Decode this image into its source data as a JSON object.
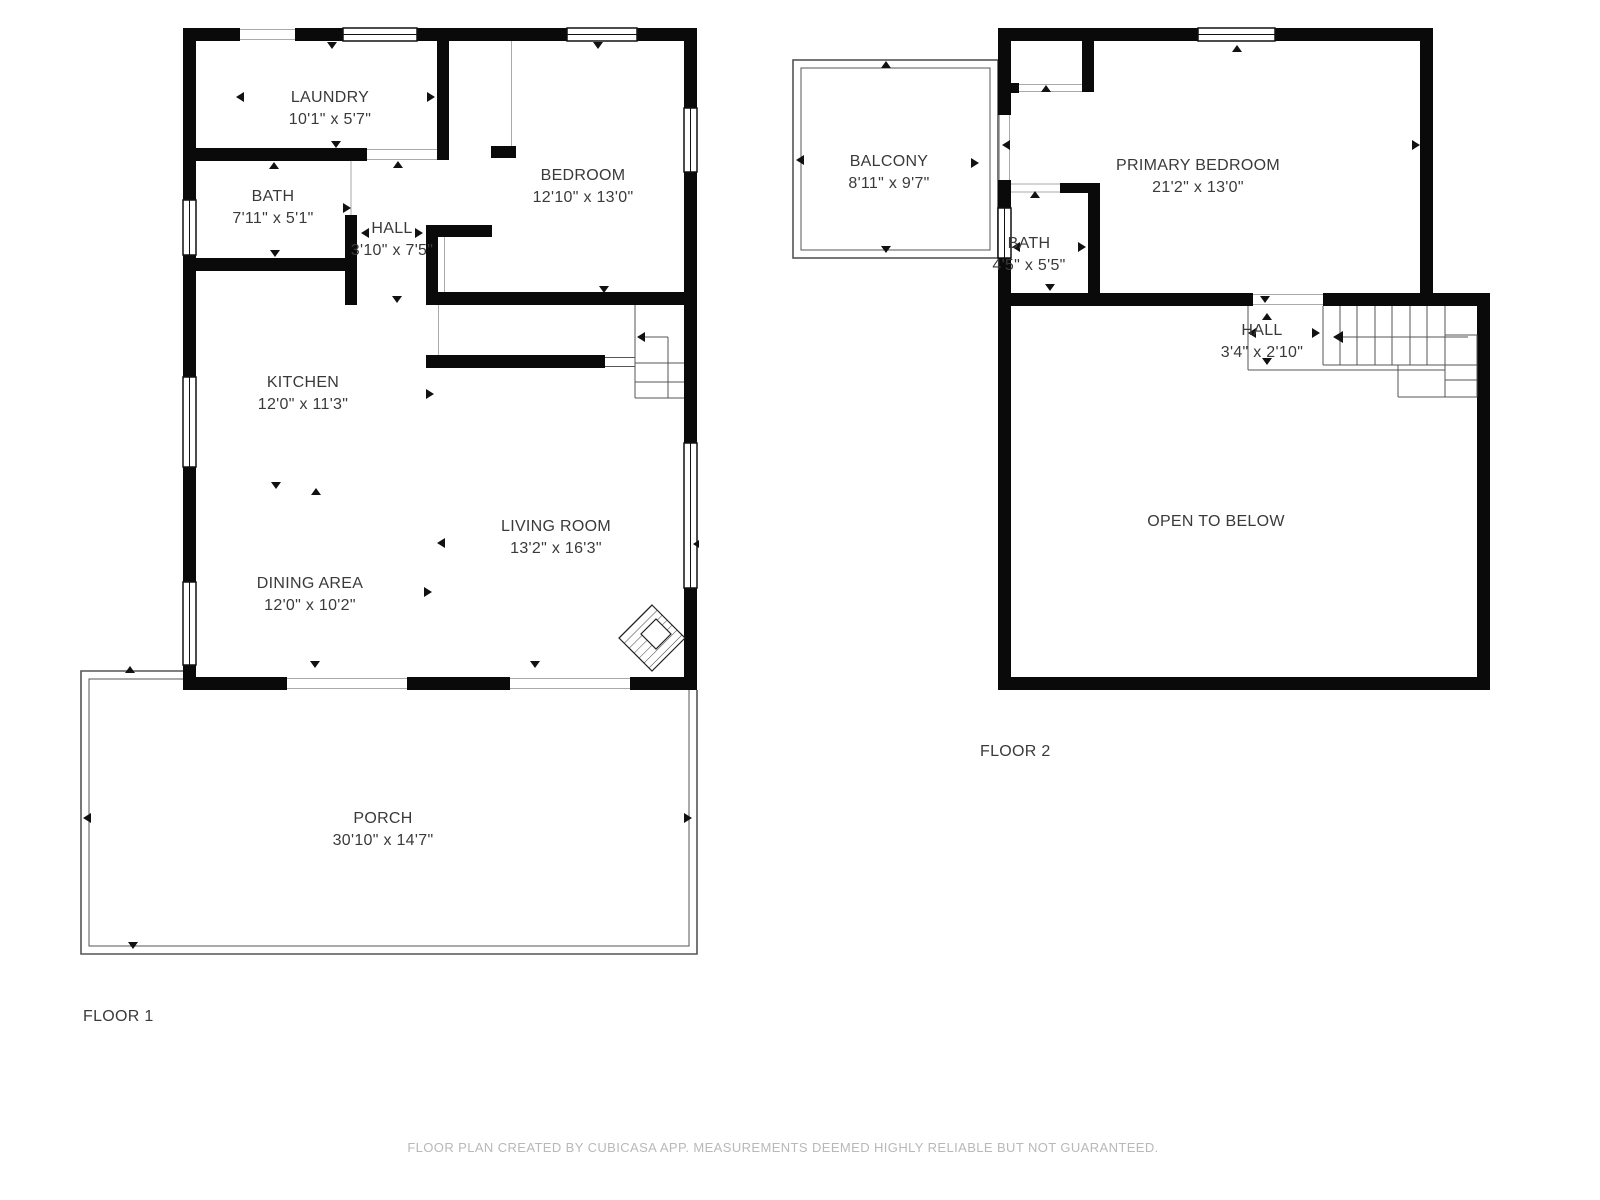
{
  "meta": {
    "disclaimer": "FLOOR PLAN CREATED BY CUBICASA APP. MEASUREMENTS DEEMED HIGHLY RELIABLE BUT NOT GUARANTEED."
  },
  "palette": {
    "wall_color": "#0a0a0a",
    "thin_line_color": "#555555",
    "label_color": "#3a3a3a",
    "disclaimer_color": "#b8b8b8"
  },
  "floor1": {
    "label": "FLOOR 1",
    "rooms": [
      {
        "name": "LAUNDRY",
        "dims": "10'1\" x 5'7\""
      },
      {
        "name": "BATH",
        "dims": "7'11\" x 5'1\""
      },
      {
        "name": "HALL",
        "dims": "3'10\" x 7'5\""
      },
      {
        "name": "BEDROOM",
        "dims": "12'10\" x 13'0\""
      },
      {
        "name": "KITCHEN",
        "dims": "12'0\" x 11'3\""
      },
      {
        "name": "DINING AREA",
        "dims": "12'0\" x 10'2\""
      },
      {
        "name": "LIVING ROOM",
        "dims": "13'2\" x 16'3\""
      },
      {
        "name": "PORCH",
        "dims": "30'10\" x 14'7\""
      }
    ]
  },
  "floor2": {
    "label": "FLOOR 2",
    "rooms": [
      {
        "name": "BALCONY",
        "dims": "8'11\" x 9'7\""
      },
      {
        "name": "PRIMARY BEDROOM",
        "dims": "21'2\" x 13'0\""
      },
      {
        "name": "BATH",
        "dims": "4'5\" x 5'5\""
      },
      {
        "name": "HALL",
        "dims": "3'4\" x 2'10\""
      },
      {
        "name": "OPEN TO BELOW",
        "dims": ""
      }
    ]
  }
}
